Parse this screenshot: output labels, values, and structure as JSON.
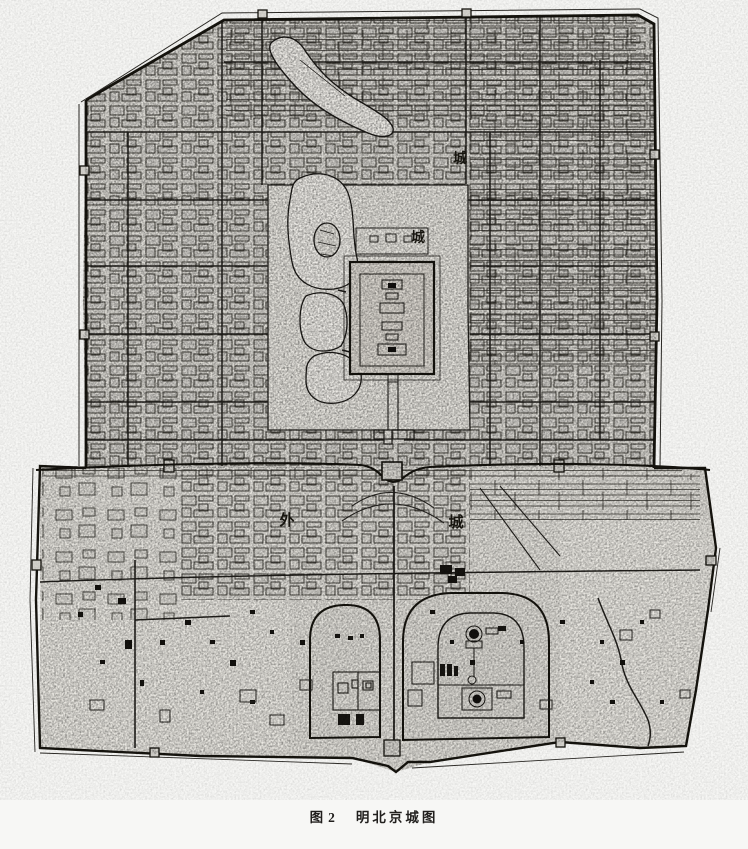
{
  "figure": {
    "caption_prefix": "图2",
    "caption_title": "明北京城图"
  },
  "map": {
    "labels": {
      "inner_city_cheng_upper": "城",
      "inner_city_cheng_lower": "城",
      "outer_city_wai": "外",
      "outer_city_cheng": "城"
    },
    "colors": {
      "ink": "#1e1c1a",
      "paper": "#f7f7f5",
      "urban_fill": "#dedcd6",
      "water_fill": "#edebe6"
    }
  }
}
